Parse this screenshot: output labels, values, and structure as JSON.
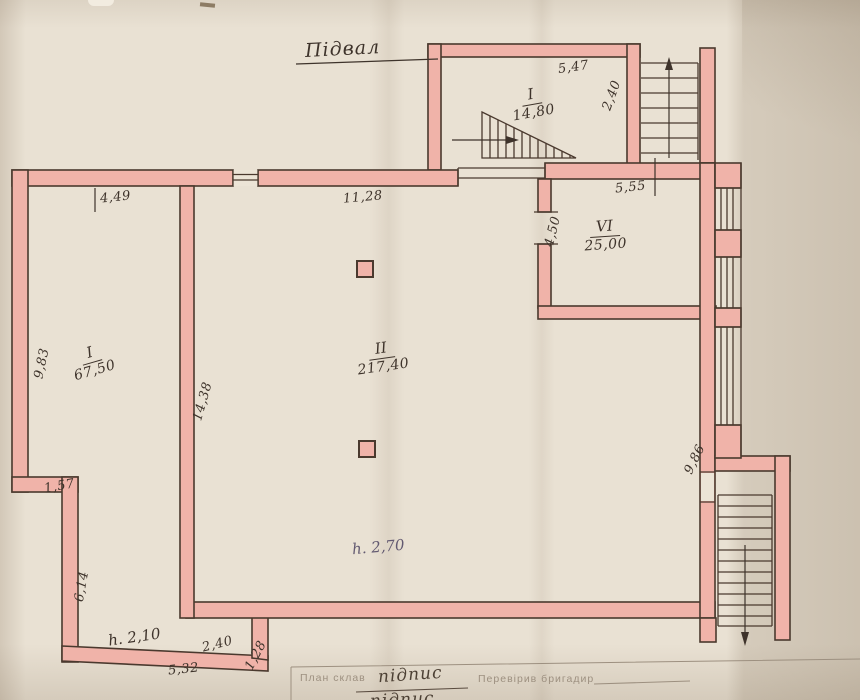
{
  "title": "Підвал",
  "rooms": {
    "annex": {
      "number": "І",
      "area": "14,80"
    },
    "left": {
      "number": "І",
      "area": "67,50"
    },
    "main": {
      "number": "ІІ",
      "area": "217,40"
    },
    "right": {
      "number": "VІ",
      "area": "25,00"
    }
  },
  "heights": {
    "main": "h. 2,70",
    "lower": "h. 2,10"
  },
  "dims": {
    "annex_top": "5,47",
    "annex_stair": "2,40",
    "top_left": "4,49",
    "top_center": "11,28",
    "room6_top": "5,55",
    "room6_left": "4,50",
    "left_outer": "9,83",
    "inner_wall": "14,38",
    "step": "1,57",
    "lower_left": "6,14",
    "bottom_left": "5,32",
    "bottom_mid": "2,40",
    "bottom_right": "1,28",
    "right_wall": "9,86"
  },
  "titleblock": {
    "made_label": "План  склав",
    "made_value": "підпис",
    "checked_label": "Перевірив бригадир",
    "row2_value": "підпис"
  },
  "colors": {
    "wall_fill": "#f0b3a9",
    "wall_line": "#4a392e",
    "ink": "#3e332b",
    "ink_purple": "#635a71",
    "print": "#9d9080"
  }
}
